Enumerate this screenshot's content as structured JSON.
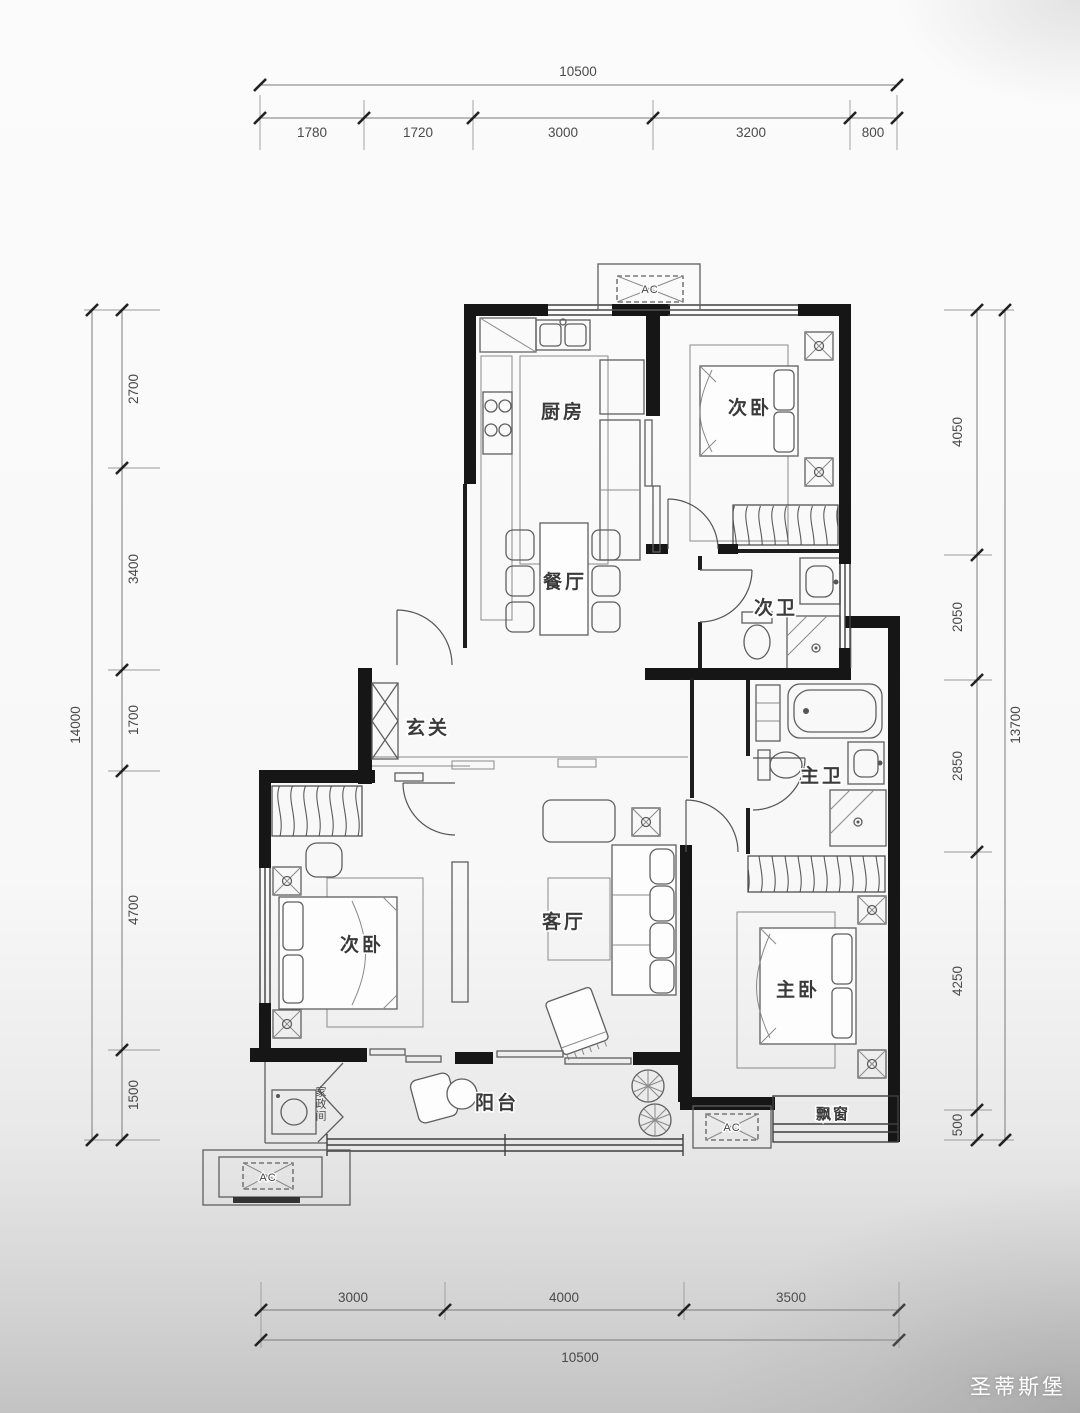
{
  "plan": {
    "rooms": {
      "kitchen": "厨房",
      "bedroom_top": "次卧",
      "dining": "餐厅",
      "bath_secondary": "次卫",
      "entry": "玄关",
      "bedroom_left": "次卧",
      "living": "客厅",
      "bath_master": "主卫",
      "bedroom_master": "主卧",
      "balcony": "阳台",
      "bay_window": "飘窗",
      "laundry": "家政间"
    },
    "ac_label": "AC"
  },
  "dimensions": {
    "top": {
      "total": "10500",
      "segments": [
        "1780",
        "1720",
        "3000",
        "3200",
        "800"
      ]
    },
    "bottom": {
      "total": "10500",
      "segments": [
        "3000",
        "4000",
        "3500"
      ]
    },
    "left": {
      "total": "14000",
      "segments": [
        "2700",
        "3400",
        "1700",
        "4700",
        "1500"
      ]
    },
    "right": {
      "total": "13700",
      "segments": [
        "4050",
        "2050",
        "2850",
        "4250",
        "500"
      ]
    }
  },
  "watermark": {
    "brand": "圣蒂斯堡"
  },
  "colors": {
    "wall": "#161616",
    "dim_line": "#6a6a6a",
    "furniture": "#5f5f5f",
    "watermark_text": "#ffffff"
  }
}
